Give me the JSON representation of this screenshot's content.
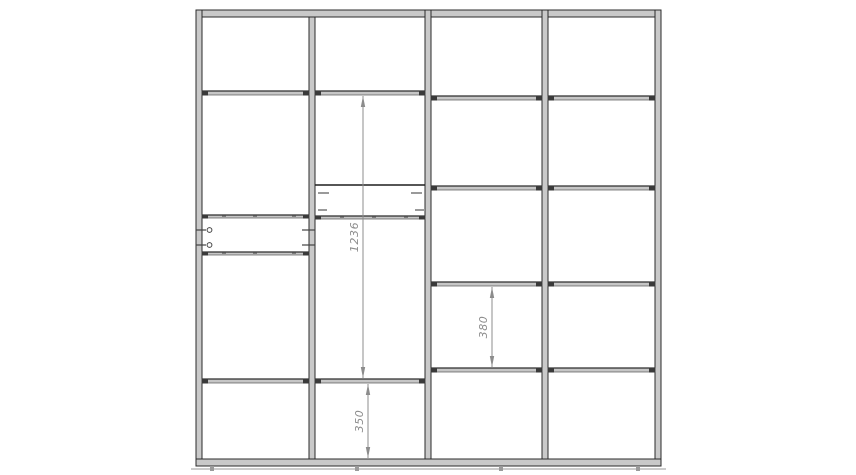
{
  "drawing": {
    "canvas": {
      "w": 856,
      "h": 475,
      "bg": "#ffffff"
    },
    "style": {
      "panel_fill": "#c9c9c9",
      "panel_stroke": "#2b2b2b",
      "shelf_fill": "#c6c6c6",
      "shelf_stroke": "#555555",
      "shelf_topline": "#2e2e2e",
      "cap_color": "#3a3a3a",
      "detail_color": "#9a9a9a",
      "rail_color": "#1f1f1f",
      "dim_color": "#8c8c8c",
      "text_color": "#8c8c8c",
      "text_size": 11
    },
    "panels": [
      {
        "name": "top-panel",
        "x": 196,
        "y": 10,
        "w": 465,
        "h": 7
      },
      {
        "name": "left-side-panel",
        "x": 196,
        "y": 10,
        "w": 6,
        "h": 456
      },
      {
        "name": "right-side-panel",
        "x": 655,
        "y": 10,
        "w": 6,
        "h": 456
      },
      {
        "name": "divider-1",
        "x": 309,
        "y": 17,
        "w": 6,
        "h": 442
      },
      {
        "name": "divider-2",
        "x": 425,
        "y": 10,
        "w": 6,
        "h": 449
      },
      {
        "name": "divider-3",
        "x": 542,
        "y": 10,
        "w": 6,
        "h": 449
      },
      {
        "name": "bottom-panel",
        "x": 196,
        "y": 459,
        "w": 465,
        "h": 7
      }
    ],
    "shelves": [
      {
        "name": "shelf-col1-top",
        "x": 202,
        "y": 91,
        "w": 107,
        "h": 4
      },
      {
        "name": "shelf-col2-top",
        "x": 315,
        "y": 91,
        "w": 110,
        "h": 4
      },
      {
        "name": "shelf-col1-thin-a",
        "x": 202,
        "y": 215,
        "w": 107,
        "h": 3,
        "ticks": [
          222,
          253,
          292
        ]
      },
      {
        "name": "shelf-col1-thin-b",
        "x": 202,
        "y": 252,
        "w": 107,
        "h": 3,
        "ticks": [
          222,
          253,
          292
        ]
      },
      {
        "name": "shelf-col2-mid",
        "x": 315,
        "y": 216,
        "w": 110,
        "h": 3,
        "ticks": [
          340,
          372,
          404
        ]
      },
      {
        "name": "shelf-col1-bottom",
        "x": 202,
        "y": 379,
        "w": 107,
        "h": 4
      },
      {
        "name": "shelf-col2-bottom",
        "x": 315,
        "y": 379,
        "w": 110,
        "h": 4
      },
      {
        "name": "shelf-col3-1",
        "x": 431,
        "y": 96,
        "w": 111,
        "h": 4
      },
      {
        "name": "shelf-col4-1",
        "x": 548,
        "y": 96,
        "w": 107,
        "h": 4
      },
      {
        "name": "shelf-col3-2",
        "x": 431,
        "y": 186,
        "w": 111,
        "h": 4
      },
      {
        "name": "shelf-col4-2",
        "x": 548,
        "y": 186,
        "w": 107,
        "h": 4
      },
      {
        "name": "shelf-col3-3",
        "x": 431,
        "y": 282,
        "w": 111,
        "h": 4
      },
      {
        "name": "shelf-col4-3",
        "x": 548,
        "y": 282,
        "w": 107,
        "h": 4
      },
      {
        "name": "shelf-col3-4",
        "x": 431,
        "y": 368,
        "w": 111,
        "h": 4
      },
      {
        "name": "shelf-col4-4",
        "x": 548,
        "y": 368,
        "w": 107,
        "h": 4
      }
    ],
    "rails": [
      {
        "name": "hanging-rail-col2",
        "x1": 315,
        "y1": 185,
        "x2": 425,
        "y2": 185
      }
    ],
    "brackets": [
      {
        "name": "bracket-col2-left-a",
        "x": 318,
        "y": 192,
        "w": 11,
        "h": 2
      },
      {
        "name": "bracket-col2-right-a",
        "x": 411,
        "y": 192,
        "w": 11,
        "h": 2
      },
      {
        "name": "bracket-col2-left-b",
        "x": 318,
        "y": 209,
        "w": 9,
        "h": 2
      },
      {
        "name": "bracket-col2-right-b",
        "x": 415,
        "y": 209,
        "w": 10,
        "h": 2
      }
    ],
    "rods": [
      {
        "name": "pullout-rod-a",
        "y": 230,
        "left_x1": 196,
        "left_x2": 206,
        "circle_x": 209.5,
        "right_x1": 302,
        "right_x2": 315
      },
      {
        "name": "pullout-rod-b",
        "y": 245,
        "left_x1": 196,
        "left_x2": 206,
        "circle_x": 209.5,
        "right_x1": 302,
        "right_x2": 315
      }
    ],
    "base_line": {
      "x1": 191,
      "y": 469,
      "x2": 666
    },
    "feet_x": [
      212,
      357,
      501,
      638
    ],
    "dimensions": [
      {
        "name": "dim-1236",
        "label": "1236",
        "x": 363,
        "y1": 96,
        "y2": 378
      },
      {
        "name": "dim-380",
        "label": "380",
        "x": 492,
        "y1": 287,
        "y2": 367
      },
      {
        "name": "dim-350",
        "label": "350",
        "x": 368,
        "y1": 384,
        "y2": 458
      }
    ]
  }
}
